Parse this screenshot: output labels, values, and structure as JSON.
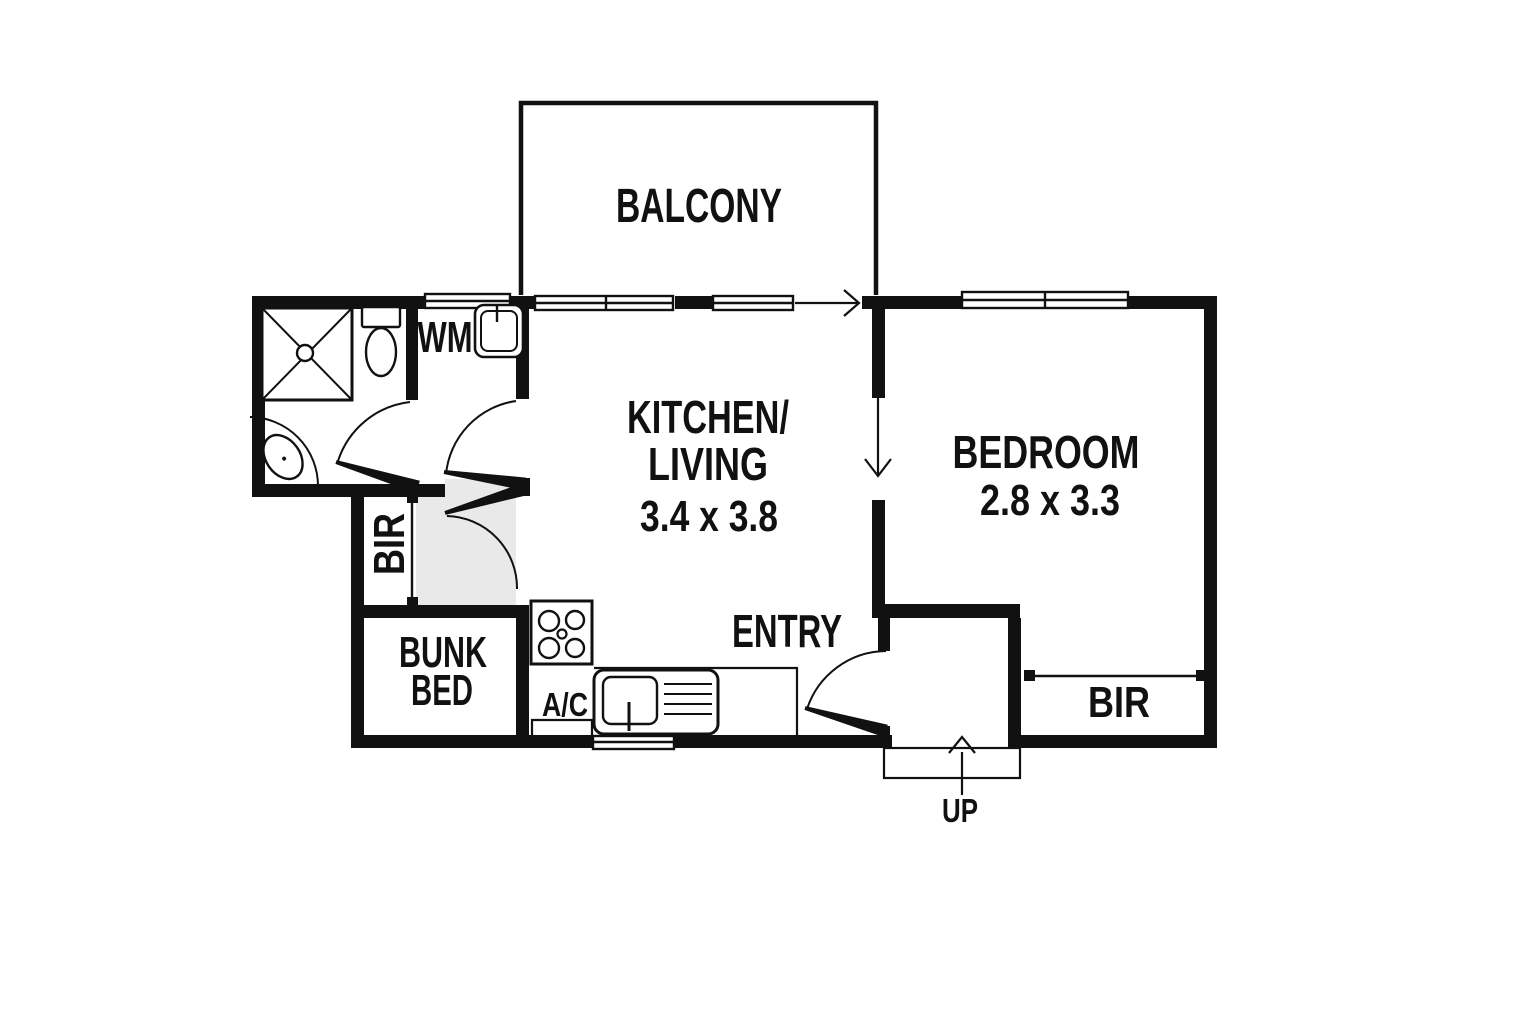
{
  "title": "apartment floor plan",
  "colors": {
    "ink": "#111111",
    "background": "#ffffff",
    "hall_shade": "#e9e9e9"
  },
  "rooms": {
    "balcony": {
      "label": "BALCONY"
    },
    "kitchen_living": {
      "label_line1": "KITCHEN/",
      "label_line2": "LIVING",
      "dimensions": "3.4 x 3.8"
    },
    "bedroom": {
      "label": "BEDROOM",
      "dimensions": "2.8 x 3.3"
    },
    "entry": {
      "label": "ENTRY"
    },
    "bunk": {
      "label_line1": "BUNK",
      "label_line2": "BED"
    },
    "bir_hall": {
      "label": "BIR"
    },
    "bir_bedroom": {
      "label": "BIR"
    }
  },
  "fixtures": {
    "washing_machine_label": "WM",
    "air_conditioner_label": "A/C",
    "stairs_label": "UP"
  }
}
